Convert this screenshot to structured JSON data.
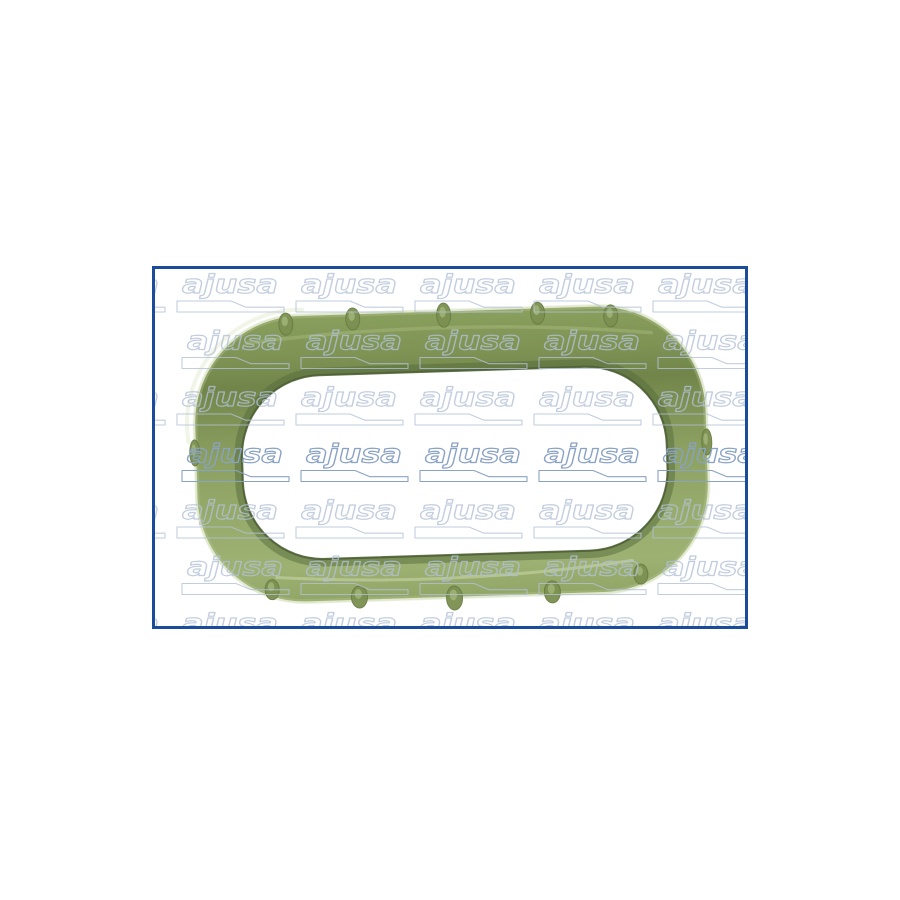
{
  "page": {
    "background": "#ffffff"
  },
  "product_photo": {
    "frame_border_color": "#1b4c99",
    "frame_background": "#ffffff",
    "subject": "green oval intake-manifold gasket seal with molded positioning pins",
    "gasket_colors": {
      "band_top": "#8aa05e",
      "band_dark": "#71854a",
      "band_mid": "#8ba061",
      "band_light": "#9db173",
      "outer_soft_edge": "#b9c993",
      "edge_highlight": "#e9efda",
      "corner_specular": "#f0f4e6",
      "bottom_sheen": "#ccd8ab",
      "inner_edge": "#4c5f35",
      "inner_shadow": "#55693c",
      "pin_fill": "#7b9051",
      "pin_stroke": "#687d42",
      "pin_highlight": "#a3b77b",
      "outline": "#7a8f50"
    },
    "watermark": {
      "text": "ajusa",
      "line_color": "#b3c1d6",
      "accent_line_color": "#8aa2c4"
    }
  }
}
